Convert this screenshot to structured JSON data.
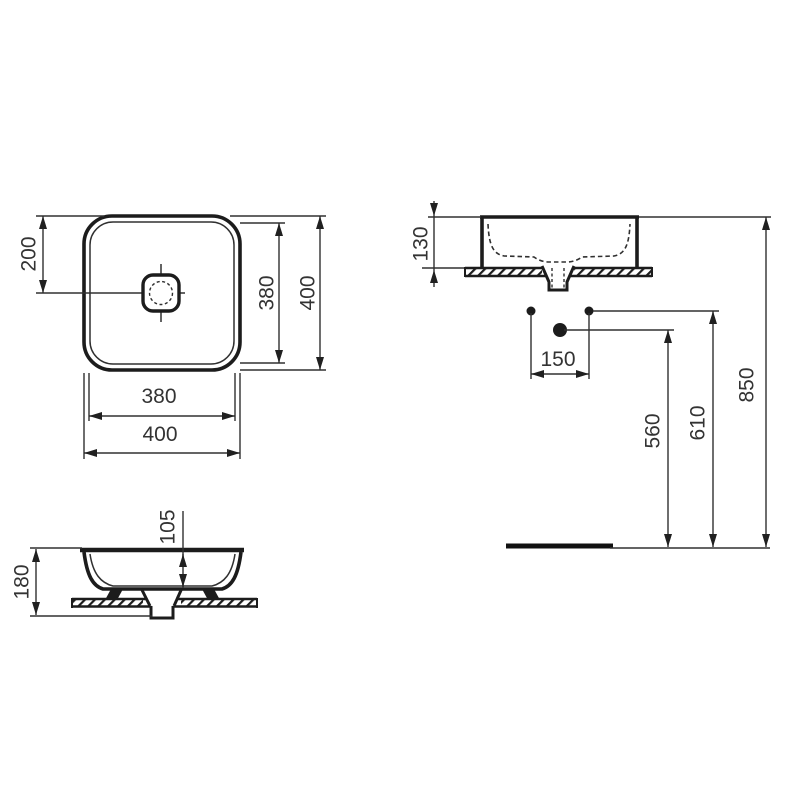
{
  "drawing": {
    "type": "washbasin-technical-dimension-drawing",
    "colors": {
      "line": "#1c1c1c",
      "thin_line": "#303030",
      "text": "#333333",
      "background": "#ffffff"
    },
    "views": {
      "plan": {
        "name": "top-plan-view",
        "dims": {
          "center_offset": "200",
          "inner_width": "380",
          "outer_width": "400",
          "inner_depth": "380",
          "outer_depth": "400"
        }
      },
      "side": {
        "name": "side-elevation-view",
        "dims": {
          "rim_above_counter": "130",
          "hole_spacing": "150",
          "drain_outlet_height": "560",
          "hole_height": "610",
          "rim_floor_height": "850"
        }
      },
      "front": {
        "name": "front-section-view",
        "dims": {
          "bowl_depth": "105",
          "overall_height": "180"
        }
      }
    }
  }
}
